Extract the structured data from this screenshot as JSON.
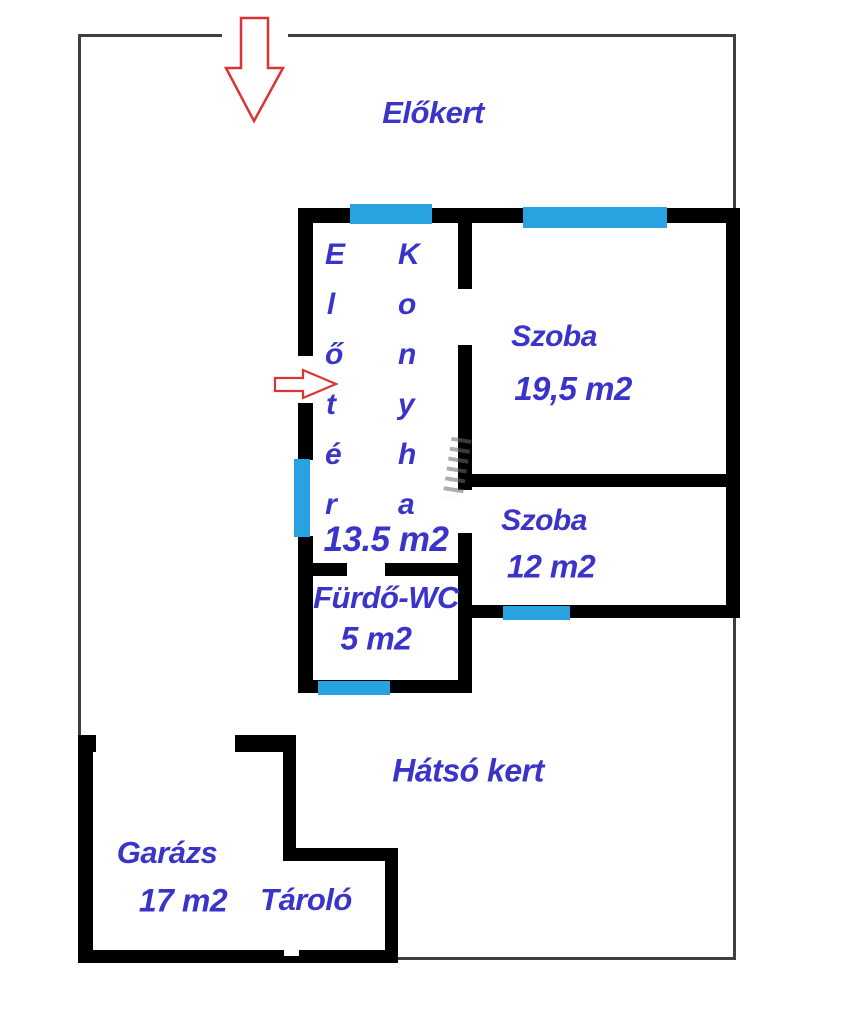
{
  "plan": {
    "front_garden_label": "Előkert",
    "back_garden_label": "Hátsó kert"
  },
  "house": {
    "hall": {
      "name": "Előtér"
    },
    "kitchen": {
      "name": "Konyha"
    },
    "hall_kitchen_area": "13.5 m2",
    "living_room": {
      "name": "Szoba",
      "area": "19,5 m2"
    },
    "bedroom": {
      "name": "Szoba",
      "area": "12 m2"
    },
    "bathroom": {
      "name": "Fürdő-WC",
      "area": "5 m2"
    }
  },
  "outbuildings": {
    "garage": {
      "name": "Garázs",
      "area": "17 m2"
    },
    "storage": {
      "name": "Tároló"
    }
  },
  "icons": {
    "street_entrance_arrow": "arrow-down",
    "main_entrance_arrow": "arrow-right",
    "window_marker": "cyan-window-strip",
    "stairs_mark": "small-stairs"
  },
  "colors": {
    "wall": "#000000",
    "window": "#29a2e2",
    "label": "#3a34c9",
    "arrow": "#d93535",
    "plot_boundary": "#3f3f3f"
  }
}
